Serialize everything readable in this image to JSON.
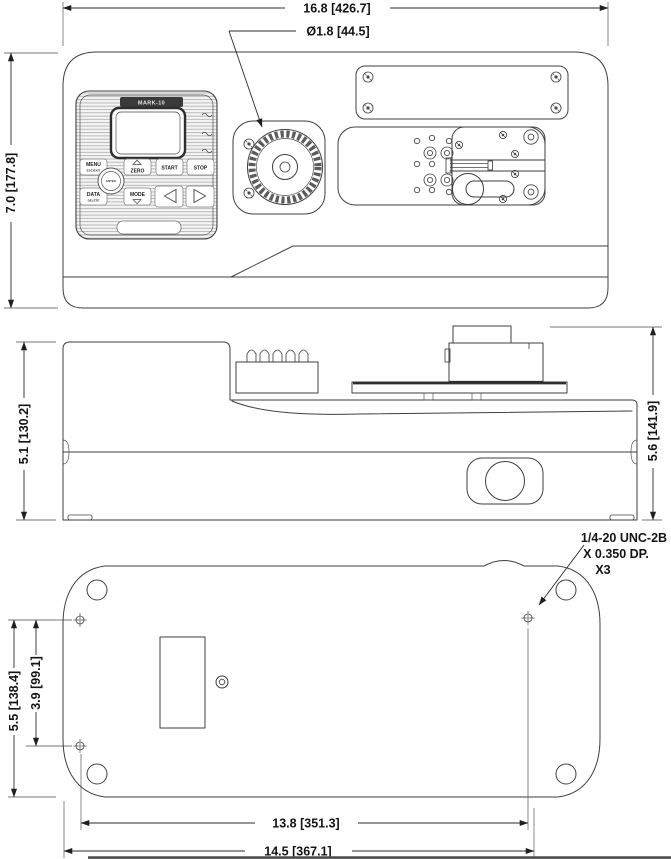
{
  "colors": {
    "line": "#3f3f3f",
    "text": "#141414",
    "background": "#ffffff"
  },
  "views": {
    "top": {
      "dim_width": "16.8 [426.7]",
      "dim_dial_diameter": "Ø1.8 [44.5]",
      "dim_depth": "7.0 [177.8]",
      "panel": {
        "brand": "MARK-10",
        "menu": "MENU",
        "menu_sub": "ESC/EXIT",
        "zero": "ZERO",
        "start": "START",
        "stop": "STOP",
        "data": "DATA",
        "data_sub": "DELETE",
        "mode": "MODE",
        "enter": "ENTER"
      }
    },
    "side": {
      "dim_height_body": "5.1 [130.2]",
      "dim_height_overall": "5.6 [141.9]"
    },
    "bottom": {
      "thread_note": [
        "1/4-20 UNC-2B",
        "X 0.350 DP.",
        "X3"
      ],
      "dim_holes_span": "5.5 [138.4]",
      "dim_holes_inner": "3.9 [99.1]",
      "dim_width_inner": "13.8 [351.3]",
      "dim_width_outer": "14.5 [367.1]"
    }
  }
}
